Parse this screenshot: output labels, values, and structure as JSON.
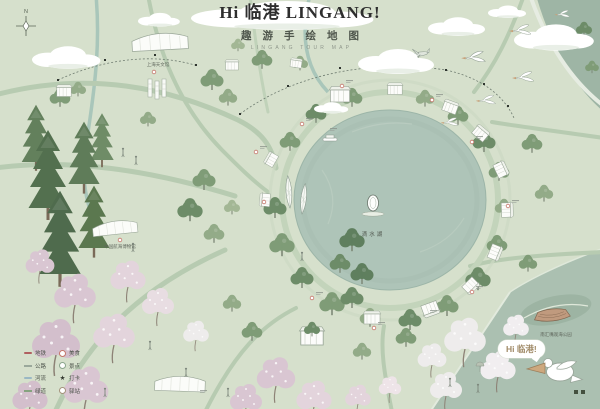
{
  "header": {
    "title": "Hi 临港 LINGANG!",
    "subtitle_cn": "趣游手绘地图",
    "subtitle_en": "LINGANG TOUR MAP"
  },
  "map": {
    "compass_n": "N",
    "lake_label": "滴水湖",
    "speech_bubble": "Hi 临港!",
    "landmarks": [
      {
        "label": "上海天文馆"
      },
      {
        "label": "中国航海博物馆"
      },
      {
        "label": "南汇嘴观海公园"
      }
    ]
  },
  "legend": {
    "left": [
      {
        "label": "地铁"
      },
      {
        "label": "公路"
      },
      {
        "label": "河流"
      },
      {
        "label": "绿道"
      }
    ],
    "right": [
      {
        "glyph": "",
        "label": "美食"
      },
      {
        "glyph": "",
        "label": "景点"
      },
      {
        "glyph": "★",
        "label": "打卡"
      },
      {
        "glyph": "",
        "label": "驿站"
      }
    ]
  },
  "colors": {
    "background": "#d6e0cc",
    "lake": "#aec4b8",
    "dark_green": "#5b774f",
    "blossom_pink": "#d9c6d2",
    "metro_red": "#b06060"
  }
}
